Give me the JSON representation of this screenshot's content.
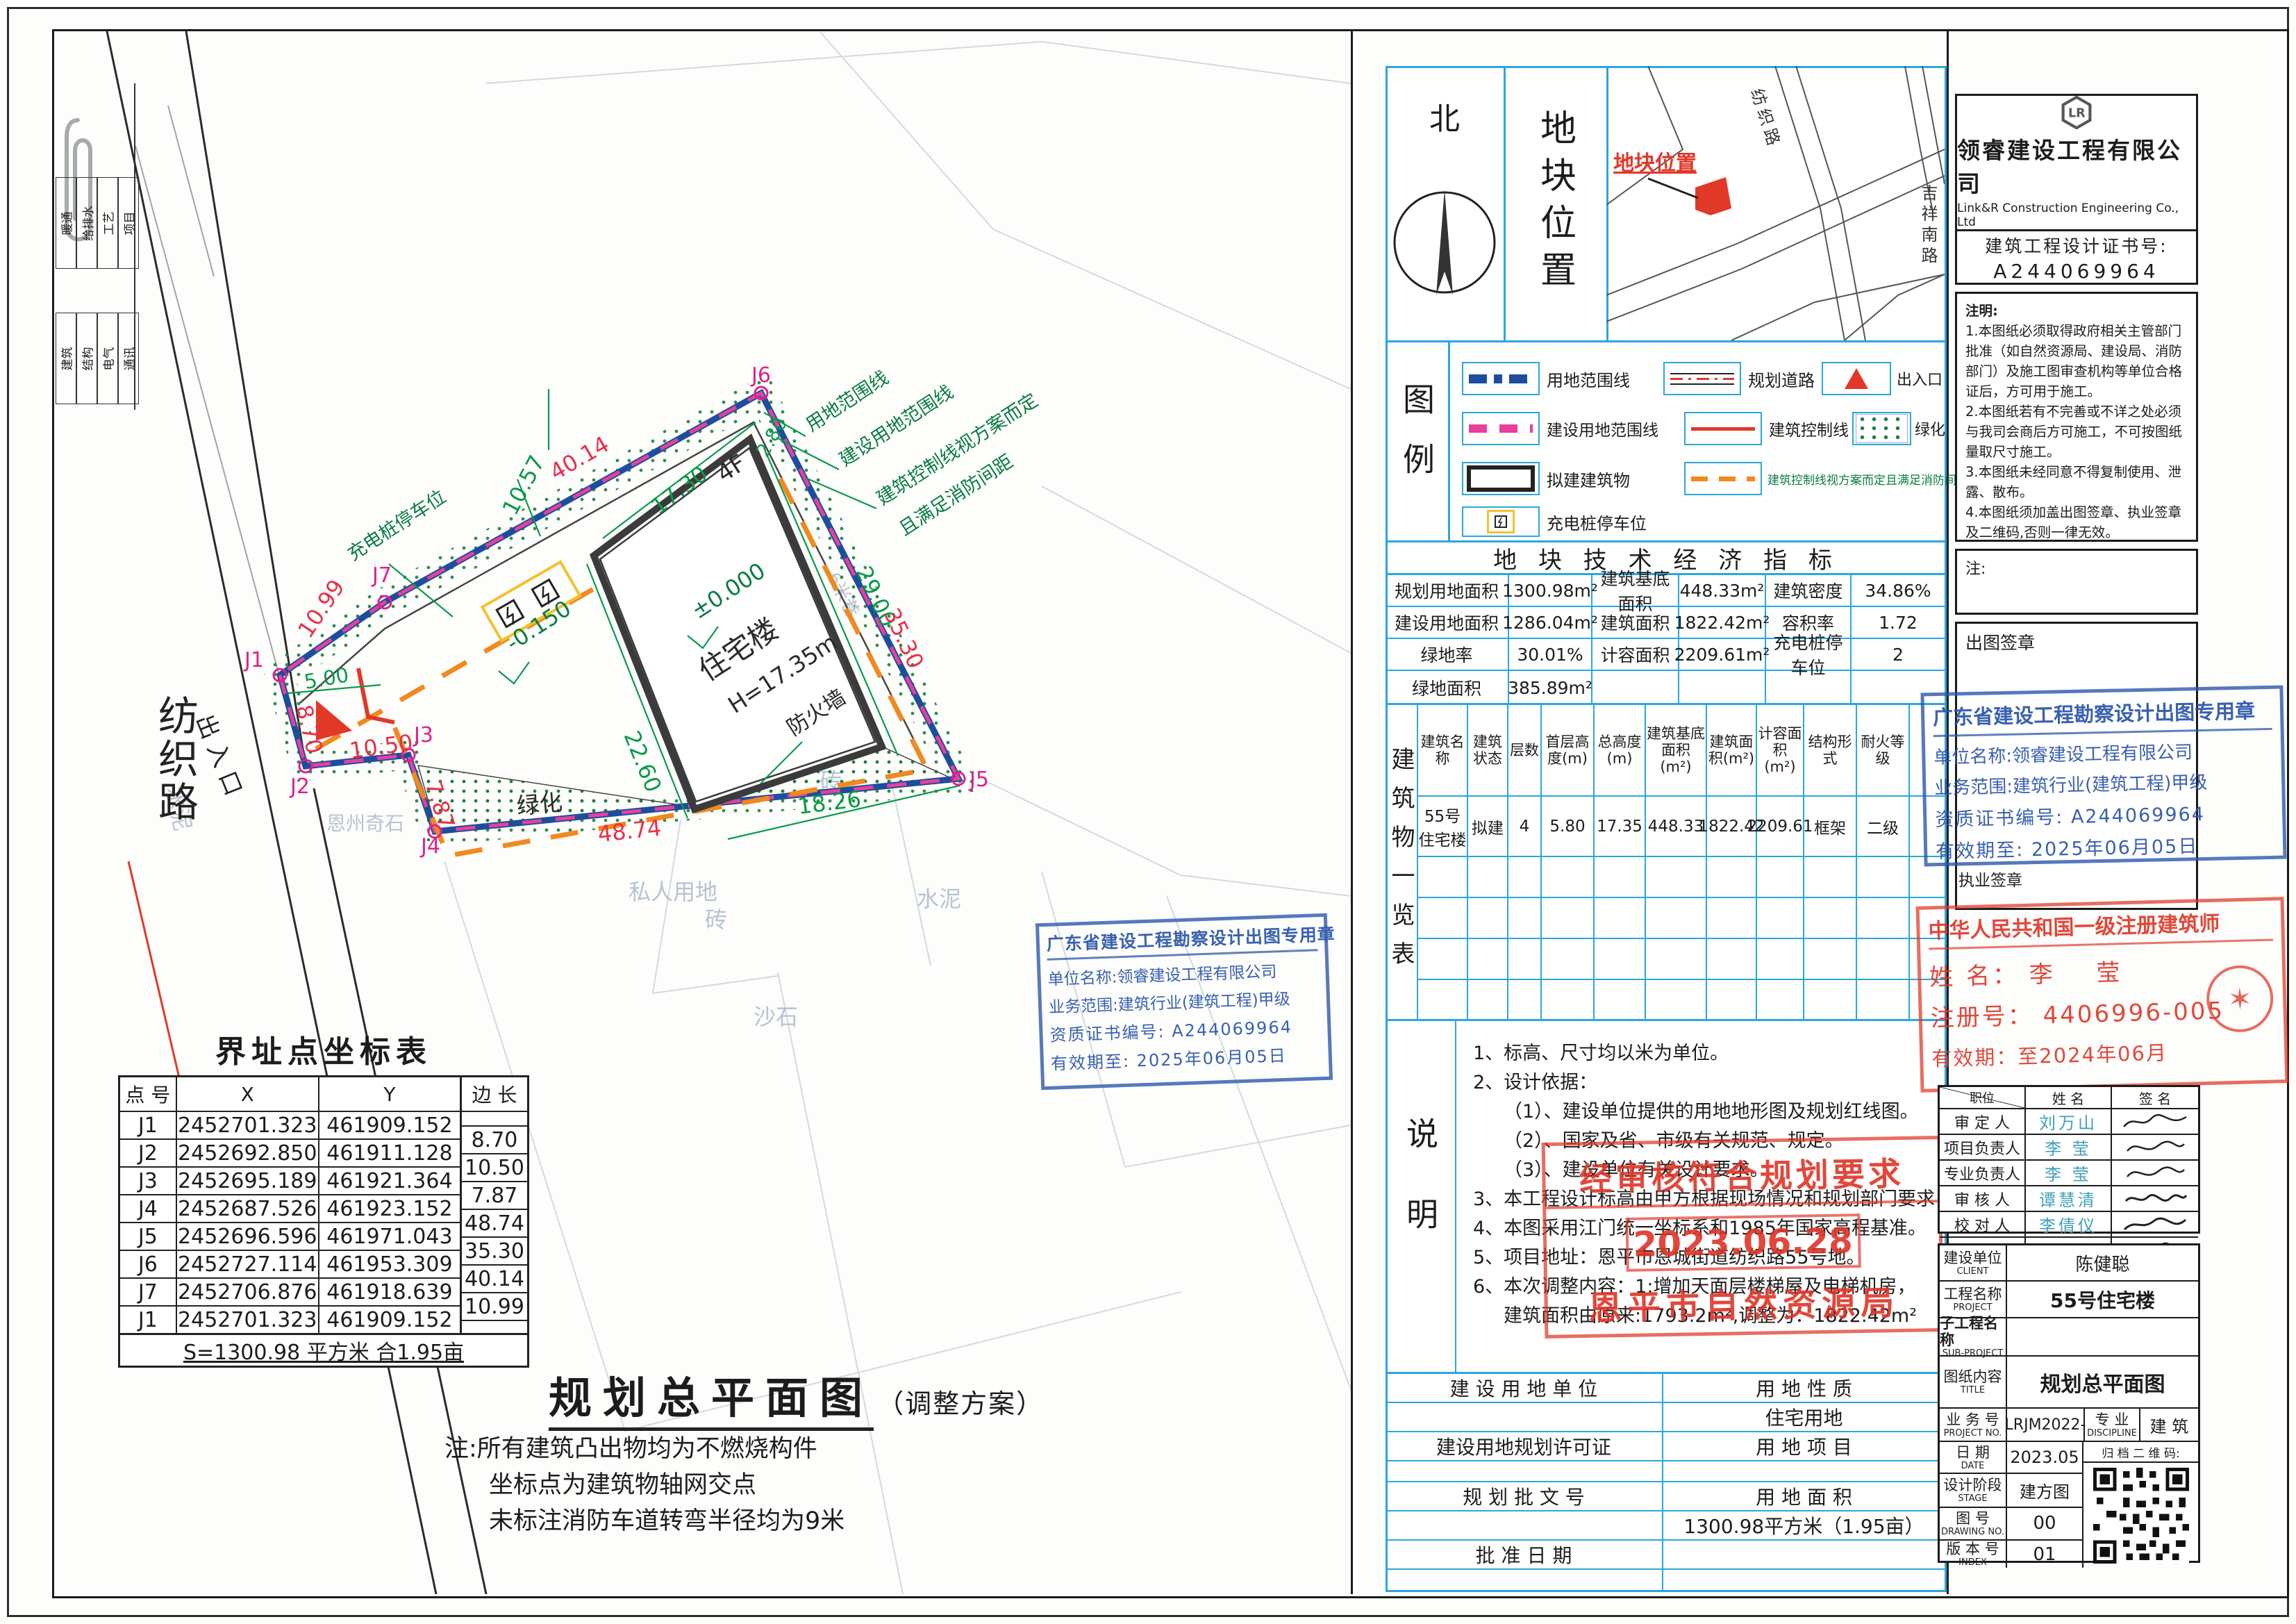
{
  "plan": {
    "road_label": "纺织路",
    "entrance_label": "出入口",
    "dims": [
      "40.14",
      "10.57",
      "17.30",
      "2.80",
      "29.00",
      "35.30",
      "22.60",
      "5.00",
      "10.99",
      "8.70",
      "10.50",
      "7.87",
      "48.74",
      "18.26"
    ],
    "points": [
      "J1",
      "J2",
      "J3",
      "J4",
      "J5",
      "J6",
      "J7"
    ],
    "leaders": [
      "用地范围线",
      "建设用地范围线",
      "建筑控制线视方案而定",
      "且满足消防间距",
      "充电桩停车位"
    ],
    "building": {
      "floors": "4F",
      "level": "±0.000",
      "name": "住宅楼",
      "height": "H=17.35m",
      "sublevel": "-0.150",
      "firewall": "防火墙"
    },
    "green_label": "绿化",
    "bg_labels": [
      "私人用地",
      "砖",
      "水泥",
      "沙石",
      "恩州奇石",
      "6米巷"
    ],
    "side_strip": [
      "暖通",
      "给排水",
      "工艺",
      "项目",
      "建筑",
      "结构",
      "电气",
      "通讯"
    ]
  },
  "coord_table": {
    "title": "界址点坐标表",
    "headers": [
      "点 号",
      "X",
      "Y",
      "边 长"
    ],
    "rows": [
      {
        "p": "J1",
        "x": "2452701.323",
        "y": "461909.152"
      },
      {
        "p": "J2",
        "x": "2452692.850",
        "y": "461911.128"
      },
      {
        "p": "J3",
        "x": "2452695.189",
        "y": "461921.364"
      },
      {
        "p": "J4",
        "x": "2452687.526",
        "y": "461923.152"
      },
      {
        "p": "J5",
        "x": "2452696.596",
        "y": "461971.043"
      },
      {
        "p": "J6",
        "x": "2452727.114",
        "y": "461953.309"
      },
      {
        "p": "J7",
        "x": "2452706.876",
        "y": "461918.639"
      },
      {
        "p": "J1",
        "x": "2452701.323",
        "y": "461909.152"
      }
    ],
    "edges": [
      "8.70",
      "10.50",
      "7.87",
      "48.74",
      "35.30",
      "40.14",
      "10.99"
    ],
    "summary": "S=1300.98 平方米 合1.95亩"
  },
  "drawing_title": {
    "main": "规划总平面图",
    "sub": "（调整方案）",
    "notes": [
      "注:所有建筑凸出物均为不燃烧构件",
      "坐标点为建筑物轴网交点",
      "未标注消防车道转弯半径均为9米"
    ]
  },
  "north": {
    "label": "北"
  },
  "location": {
    "panel_label": "地块位置",
    "marker_label": "地块位置",
    "road1": "纺织路",
    "road2": "吉祥南路"
  },
  "legend": {
    "panel_label": "图例",
    "items": [
      {
        "label": "用地范围线"
      },
      {
        "label": "规划道路"
      },
      {
        "label": "出入口"
      },
      {
        "label": "建设用地范围线"
      },
      {
        "label": "建筑控制线"
      },
      {
        "label": "绿化"
      },
      {
        "label": "拟建建筑物"
      },
      {
        "label": "建筑控制线视方案而定且满足消防间距"
      },
      {
        "label": "充电桩停车位"
      }
    ]
  },
  "indicators": {
    "title": "地 块  技 术 经 济 指 标",
    "cells": [
      {
        "label": "规划用地面积",
        "value": "1300.98m²"
      },
      {
        "label": "建筑基底面积",
        "value": "448.33m²"
      },
      {
        "label": "建筑密度",
        "value": "34.86%"
      },
      {
        "label": "建设用地面积",
        "value": "1286.04m²"
      },
      {
        "label": "建筑面积",
        "value": "1822.42m²"
      },
      {
        "label": "容积率",
        "value": "1.72"
      },
      {
        "label": "绿地率",
        "value": "30.01%"
      },
      {
        "label": "计容面积",
        "value": "2209.61m²"
      },
      {
        "label": "充电桩停车位",
        "value": "2"
      },
      {
        "label": "绿地面积",
        "value": "385.89m²"
      }
    ]
  },
  "buildings": {
    "panel_label": "建筑物一览表",
    "headers": [
      "建筑名称",
      "建筑状态",
      "层数",
      "首层高度(m)",
      "总高度(m)",
      "建筑基底面积(m²)",
      "建筑面积(m²)",
      "计容面积(m²)",
      "结构形式",
      "耐火等级"
    ],
    "row": [
      "55号住宅楼",
      "拟建",
      "4",
      "5.80",
      "17.35",
      "448.33",
      "1822.42",
      "2209.61",
      "框架",
      "二级"
    ]
  },
  "notes": {
    "panel_label": "说明",
    "lines": [
      "1、标高、尺寸均以米为单位。",
      "2、设计依据：",
      "（1）、建设单位提供的用地地形图及规划红线图。",
      "（2）、国家及省、市级有关规范、规定。",
      "（3）、建设单位有关设计要求。",
      "3、本工程设计标高由甲方根据现场情况和规划部门要求自行放标高确定。",
      "4、本图采用江门统一坐标系和1985年国家高程基准。",
      "5、项目地址：恩平市恩城街道纺织路55号地。",
      "6、本次调整内容：1:增加天面层楼梯屋及电梯机房，",
      "建筑面积由原来:1793.2m²,调整为：1822.42m²"
    ]
  },
  "landuse": {
    "rows": [
      {
        "left": "建 设 用 地 单 位",
        "right": "用 地 性 质"
      },
      {
        "left": "",
        "right": "住宅用地"
      },
      {
        "left": "建设用地规划许可证",
        "right": "用 地 项 目"
      },
      {
        "left": "",
        "right": ""
      },
      {
        "left": "规 划 批 文 号",
        "right": "用 地 面 积"
      },
      {
        "left": "",
        "right": "1300.98平方米（1.95亩）"
      },
      {
        "left": "批 准 日 期",
        "right": ""
      },
      {
        "left": "",
        "right": ""
      }
    ]
  },
  "company": {
    "logo_text": "LR",
    "name_cn": "领睿建设工程有限公司",
    "name_en": "Link&R Construction Engineering Co., Ltd",
    "cert_label": "建筑工程设计证书号:",
    "cert_no": "A244069964",
    "notes_title": "注明:",
    "notes": [
      "1.本图纸必须取得政府相关主管部门批准（如自然资源局、建设局、消防部门）及施工图审查机构等单位合格证后，方可用于施工。",
      "2.本图纸若有不完善或不详之处必须与我司会商后方可施工，不可按图纸量取尺寸施工。",
      "3.本图纸未经同意不得复制使用、泄露、散布。",
      "4.本图纸须加盖出图签章、执业签章及二维码,否则一律无效。"
    ],
    "note2_title": "注:"
  },
  "stamps": {
    "issue_label": "出图签章",
    "practice_label": "执业签章",
    "blue": {
      "title": "广东省建设工程勘察设计出图专用章",
      "line1": "单位名称:领睿建设工程有限公司",
      "line2": "业务范围:建筑行业(建筑工程)甲级",
      "line3": "资质证书编号: A244069964",
      "line4": "有效期至: 2025年06月05日"
    },
    "architect": {
      "title": "中华人民共和国一级注册建筑师",
      "name_label": "姓  名：",
      "name": "李 莹",
      "reg_label": "注册号：",
      "reg_no": "4406996-005",
      "valid": "有效期：至2024年06月"
    },
    "approval": {
      "line1": "经审核符合规划要求",
      "date": "2023.06.28",
      "agency": "恩平市自然资源局"
    }
  },
  "signoff": {
    "header": {
      "role": "职位",
      "name": "姓 名",
      "sign": "签 名"
    },
    "rows": [
      {
        "role": "审 定 人",
        "name": "刘万山"
      },
      {
        "role": "项目负责人",
        "name": "李 莹"
      },
      {
        "role": "专业负责人",
        "name": "李 莹"
      },
      {
        "role": "审 核 人",
        "name": "谭慧清"
      },
      {
        "role": "校 对 人",
        "name": "李倩仪"
      },
      {
        "role": "设  计",
        "name": "冯杰枫"
      }
    ]
  },
  "titleblock": {
    "client_label_cn": "建设单位",
    "client_label_en": "CLIENT",
    "client": "陈健聪",
    "project_label_cn": "工程名称",
    "project_label_en": "PROJECT",
    "project": "55号住宅楼",
    "sub_label_cn": "子工程名称",
    "sub_label_en": "SUB-PROJECT",
    "sub": "",
    "title_label_cn": "图纸内容",
    "title_label_en": "TITLE",
    "title": "规划总平面图",
    "no_label_cn": "业 务 号",
    "no_label_en": "PROJECT NO.",
    "no": "LRJM2022-",
    "disc_label_cn": "专 业",
    "disc_label_en": "DISCIPLINE",
    "disc": "建 筑",
    "date_label_cn": "日 期",
    "date_label_en": "DATE",
    "date": "2023.05",
    "qr_label": "归 档 二 维 码:",
    "stage_label_cn": "设计阶段",
    "stage_label_en": "STAGE",
    "stage": "建方图",
    "dwg_label_cn": "图 号",
    "dwg_label_en": "DRAWING NO.",
    "dwg": "00",
    "index_label_cn": "版 本 号",
    "index_label_en": "INDEX",
    "index": "01"
  }
}
